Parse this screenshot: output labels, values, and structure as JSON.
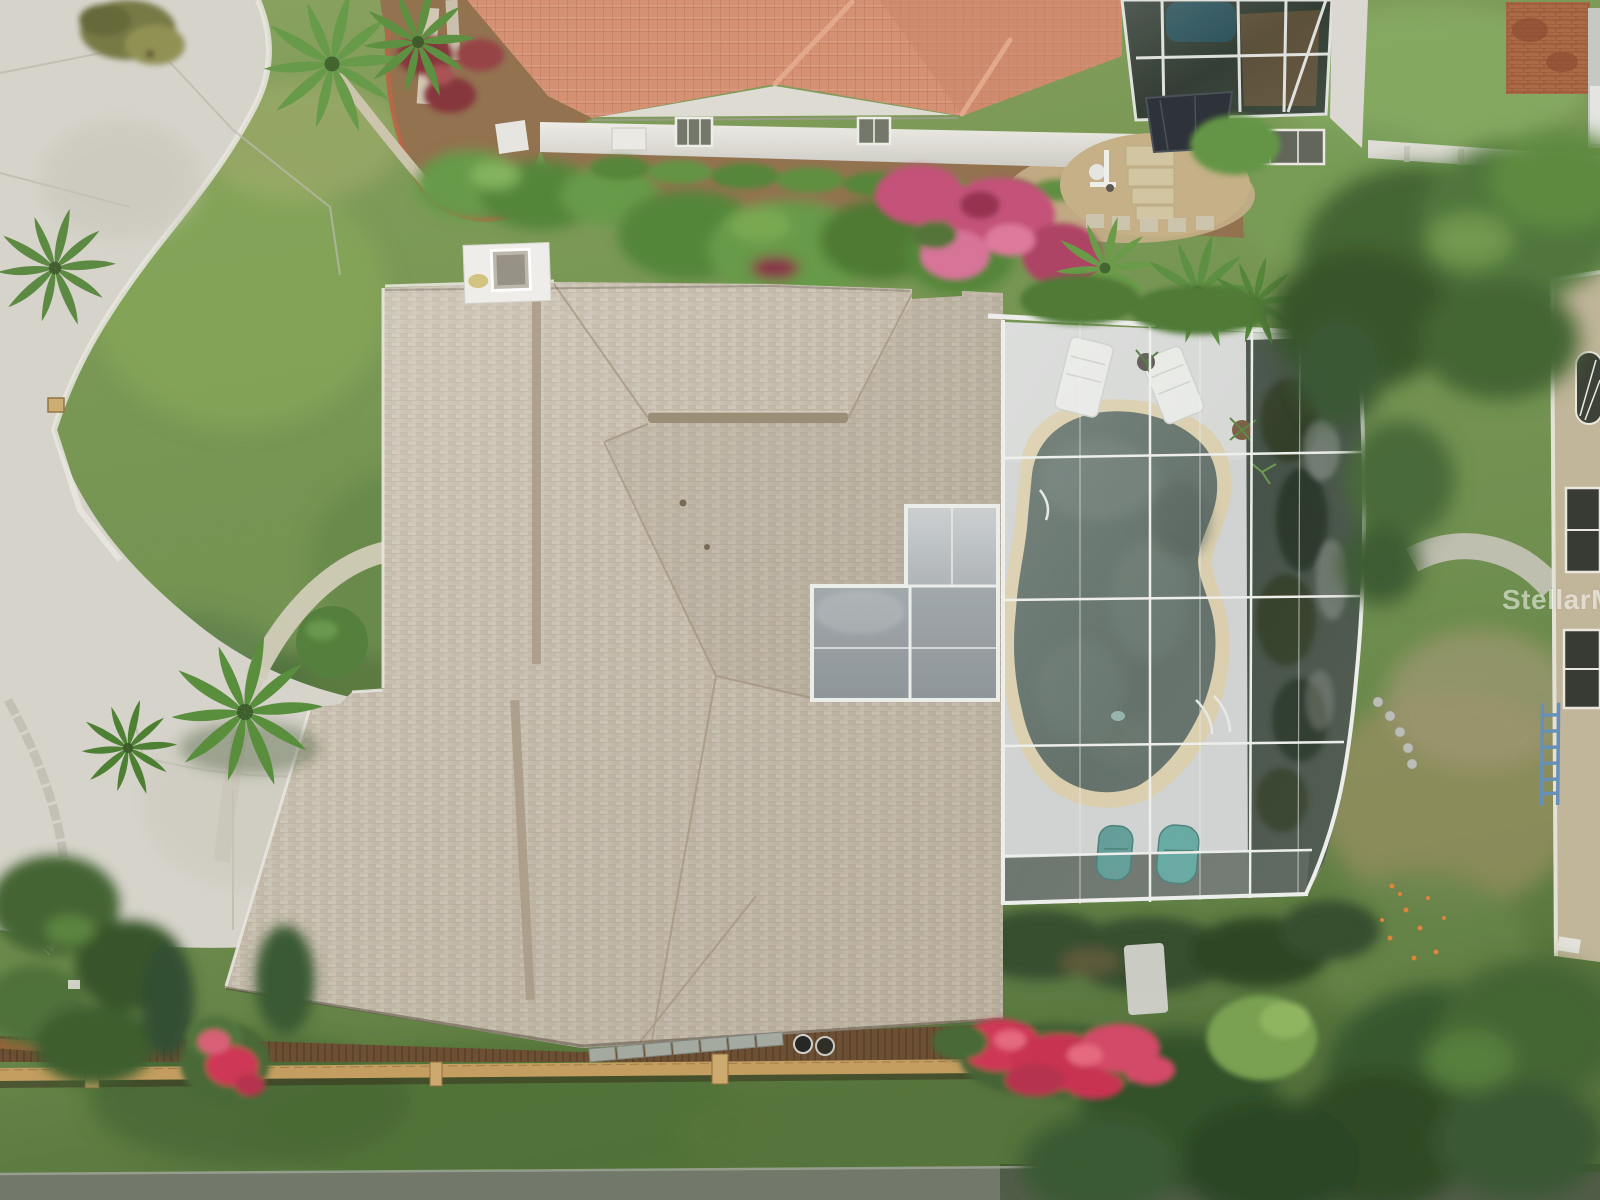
{
  "meta": {
    "type": "aerial-drone-photograph",
    "description": "Overhead drone view of a single-family home with tan shingle hip roof and screened-in kidney-shaped swimming pool, flanked by a terracotta tile-roof neighbor above, a two-story neighbor at right, lawns, a cul-de-sac driveway at left and a wood rail fence along the bottom"
  },
  "watermark": {
    "text": "StellarMLS"
  },
  "colors": {
    "grass_base": "#6a8a4a",
    "grass_light": "#86a55c",
    "grass_dark": "#3f5c2d",
    "concrete": "#d5d2c8",
    "road_strip": "#686e62",
    "roof_shingle": "#c9bfae",
    "roof_ridge": "#a2937c",
    "chimney_white": "#efeeea",
    "tile_roof": "#d4886b",
    "wall_white": "#e2e0d8",
    "mulch": "#8a6847",
    "gravel": "#c2aa7f",
    "brick_edge": "#b25c3c",
    "pool_water": "#57655f",
    "pool_coping": "#d8cba6",
    "pool_deck": "#cdd0cf",
    "screen_dark": "#3a463c",
    "frame_white": "#eef0ec",
    "neighbor_pool": "#1f454e",
    "brick_patio": "#a5613c",
    "fence_brown": "#64462a",
    "fence_rail": "#c09658",
    "flower_pink": "#c04a70",
    "flower_red": "#cc2f4e",
    "flower_orange": "#dd7b2e",
    "tree_dark": "#31502a",
    "shrub_green": "#5d9140",
    "neighbor_wall": "#bdb092",
    "ladder_blue": "#5d86b5",
    "lounger_white": "#e8eae6",
    "chair_teal": "#55948e"
  },
  "scene": {
    "regions": [
      {
        "id": "main-house-roof",
        "label": "Tan shingle hip roof of main house"
      },
      {
        "id": "chimney",
        "label": "White chimney cap with skylight"
      },
      {
        "id": "pool-enclosure",
        "label": "Screened pool cage with white aluminum frame"
      },
      {
        "id": "swimming-pool",
        "label": "Kidney-shaped pool with dark teal water and stone coping"
      },
      {
        "id": "pool-deck",
        "label": "Concrete pool deck with white loungers and teal chairs"
      },
      {
        "id": "lanai-screen",
        "label": "L-shaped gray screen panels over lanai"
      },
      {
        "id": "cul-de-sac",
        "label": "Concrete cul-de-sac and driveway, left side"
      },
      {
        "id": "front-lawn",
        "label": "Front lawn with ponytail palm and clipped round bush"
      },
      {
        "id": "walkway",
        "label": "Curved concrete walkway at front corner"
      },
      {
        "id": "neighbor-tile-roof",
        "label": "Neighbor house with terracotta barrel-tile roof, top"
      },
      {
        "id": "landscape-beds",
        "label": "Mulched beds with brick edging, hedges and pink bougainvillea"
      },
      {
        "id": "neighbor-pool-cage",
        "label": "Neighbor screened pool enclosure, top right"
      },
      {
        "id": "stepping-stones",
        "label": "Paver path, gravel bed and pool equipment"
      },
      {
        "id": "brick-patio",
        "label": "Brick paver patio, top right corner"
      },
      {
        "id": "right-house",
        "label": "Two-story neighbor house at right edge with arched window and blue ladder"
      },
      {
        "id": "back-fence",
        "label": "Wood rail fence along back property line"
      },
      {
        "id": "crape-myrtle",
        "label": "Red flowering shrub at fence line"
      },
      {
        "id": "road-strip",
        "label": "Gray pavement strip across bottom edge"
      },
      {
        "id": "trees",
        "label": "Mature green canopy trees on right and bottom"
      },
      {
        "id": "watermark",
        "label": "StellarMLS watermark, right middle"
      }
    ]
  }
}
